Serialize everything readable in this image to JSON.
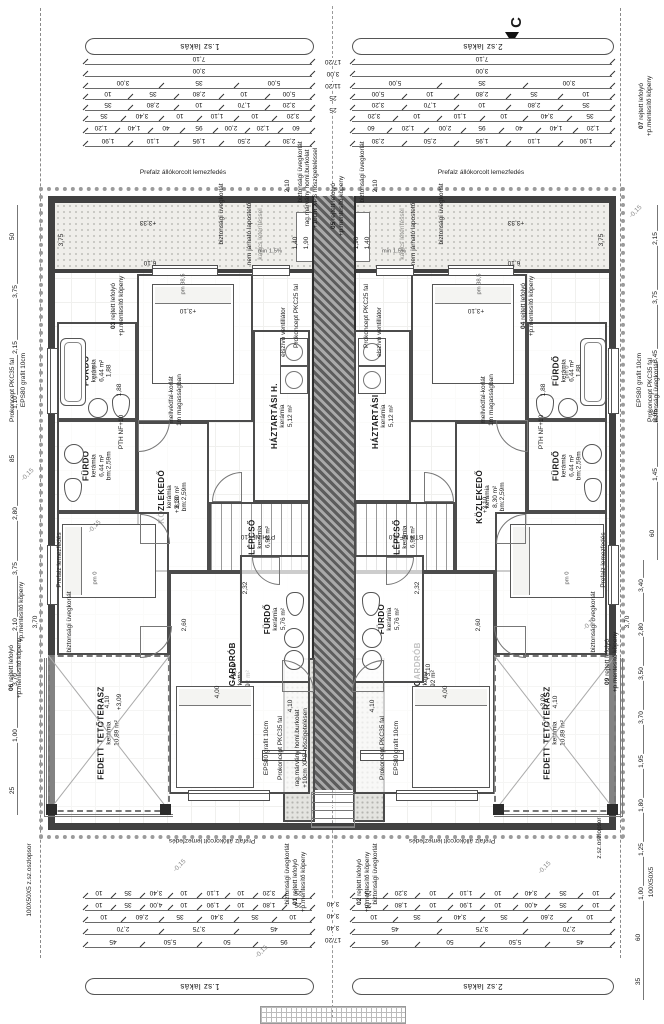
{
  "meta": {
    "drawing_type": "emeleti alaprajz (duplex floor plan)",
    "section_marker": "C",
    "units": [
      "1.sz lakás",
      "2.sz lakás"
    ]
  },
  "colors": {
    "wall": "#414141",
    "line": "#6a6a6a",
    "text": "#1a1a1a",
    "roof_fill": "#efeeea",
    "hatch": "#a9a9a9",
    "marker": "#111111"
  },
  "banners": {
    "top_left": "1.sz lakás",
    "top_right": "2.sz lakás",
    "bottom_left": "1.sz lakás",
    "bottom_right": "2.sz lakás"
  },
  "rooms": [
    {
      "name": "FÜRDŐ",
      "finish": "kerámia",
      "area": "6,44 m²",
      "extra": "1,88",
      "x": 57,
      "y": 322,
      "w": 80,
      "h": 98
    },
    {
      "name": "FÜRDŐ",
      "finish": "kerámia",
      "area": "6,44 m²",
      "extra": "bm:2,59m",
      "x": 57,
      "y": 420,
      "w": 80,
      "h": 92
    },
    {
      "name": "SZOBA",
      "finish": "parketta",
      "area": "15,00 m²",
      "extra": "bm:2,59m",
      "x": 137,
      "y": 274,
      "w": 116,
      "h": 148
    },
    {
      "name": "HÁZTARTÁSI H.",
      "finish": "kerámia",
      "area": "5,12 m²",
      "extra": "",
      "x": 253,
      "y": 330,
      "w": 57,
      "h": 172
    },
    {
      "name": "KÖZLEKEDŐ",
      "finish": "kerámia",
      "area": "8,30 m²",
      "extra": "bm:2,59m",
      "x": 137,
      "y": 422,
      "w": 72,
      "h": 150
    },
    {
      "name": "LÉPCSŐ",
      "finish": "kerámia",
      "area": "6,98 m²",
      "extra": "",
      "x": 209,
      "y": 502,
      "w": 101,
      "h": 70,
      "kind": "stairs"
    },
    {
      "name": "SZOBA",
      "finish": "parketta",
      "area": "16,35 m²",
      "extra": "",
      "x": 57,
      "y": 512,
      "w": 112,
      "h": 143
    },
    {
      "name": "SZOBA+ GARDRÓB",
      "finish": "parketta",
      "area": "23,92 m²",
      "extra": "",
      "x": 169,
      "y": 572,
      "w": 141,
      "h": 222
    },
    {
      "name": "FÜRDŐ",
      "finish": "kerámia",
      "area": "5,76 m²",
      "extra": "",
      "x": 240,
      "y": 555,
      "w": 70,
      "h": 128
    },
    {
      "name": "FEDETT TETŐTERASZ",
      "finish": "kerámia",
      "area": "10,89 m²",
      "extra": "",
      "x": 48,
      "y": 655,
      "w": 122,
      "h": 157,
      "kind": "terrace"
    }
  ],
  "notes": [
    {
      "num": "01",
      "text": "rejtett lefolyó\n+p.mentesítő köpeny",
      "x": 300,
      "y": 882
    },
    {
      "num": "02",
      "text": "rejtett lefolyó\n+p.mentesítő köpeny",
      "x": 364,
      "y": 882
    },
    {
      "num": "03",
      "text": "rejtett lefolyó\n+p.mentesítő köpeny",
      "x": 118,
      "y": 306
    },
    {
      "num": "04",
      "text": "rejtett lefolyó\n+p.mentesítő köpeny",
      "x": 528,
      "y": 306
    },
    {
      "num": "05",
      "text": "rejtett lefolyó\n+p.mentesítő köpeny",
      "x": 338,
      "y": 206
    },
    {
      "num": "06",
      "text": "rejtett lefolyó\n+p.mentesítő köpeny",
      "x": 16,
      "y": 668
    },
    {
      "num": "07",
      "text": "rejtett lefolyó\n+p.mentesítő köpeny",
      "x": 646,
      "y": 106
    },
    {
      "num": "09",
      "text": "rejtett lefolyó\n+p.mentesítő köpeny",
      "x": 612,
      "y": 662
    }
  ],
  "annotations": [
    {
      "t": "Prefalz állókorcolt lemezfedés",
      "x": 183,
      "y": 173,
      "r": "h",
      "m": true
    },
    {
      "t": "biztonsági üvegkorlát",
      "x": 222,
      "y": 214,
      "r": "v",
      "m": true
    },
    {
      "t": "nem járható lapostető",
      "x": 250,
      "y": 234,
      "r": "v",
      "m": true
    },
    {
      "t": "kavics leterítéssel",
      "x": 261,
      "y": 234,
      "r": "v",
      "m": true,
      "cls": "gray"
    },
    {
      "t": "+3,33",
      "x": 148,
      "y": 222,
      "r": "u",
      "m": true
    },
    {
      "t": "6,10",
      "x": 150,
      "y": 262,
      "r": "u",
      "m": true
    },
    {
      "t": "3,75",
      "x": 62,
      "y": 240,
      "r": "v",
      "m": true
    },
    {
      "t": "1,40",
      "x": 296,
      "y": 243,
      "r": "v",
      "m": true
    },
    {
      "t": "1,90",
      "x": 307,
      "y": 243,
      "r": "v",
      "m": true
    },
    {
      "t": "min 1,5%",
      "x": 270,
      "y": 252,
      "r": "h",
      "m": true,
      "cls": "small"
    },
    {
      "t": "rag.márvány homl.burkolat\n+10cm XPS hőszigeteléssel",
      "x": 312,
      "y": 188,
      "r": "v",
      "m": false
    },
    {
      "t": "biztonsági üvegkorlát",
      "x": 301,
      "y": 172,
      "r": "v",
      "m": true
    },
    {
      "t": "2,10",
      "x": 288,
      "y": 186,
      "r": "v",
      "m": true
    },
    {
      "t": "Prokoncept PKC25 fal",
      "x": 297,
      "y": 316,
      "r": "v",
      "m": true
    },
    {
      "t": "elszívó ventillátor",
      "x": 284,
      "y": 332,
      "r": "v",
      "m": true
    },
    {
      "t": "EPS80 grafit 10cm",
      "x": 24,
      "y": 380,
      "r": "v",
      "m": true
    },
    {
      "t": "Prokoncept PKC35 fal",
      "x": 13,
      "y": 390,
      "r": "v",
      "m": true
    },
    {
      "t": "biztonsági üvegkorlát",
      "x": 657,
      "y": 392,
      "r": "v",
      "m": false
    },
    {
      "t": "mellvédfal-korlát\n1m magasságban",
      "x": 176,
      "y": 400,
      "r": "v",
      "m": true
    },
    {
      "t": "PTH NF+10",
      "x": 122,
      "y": 432,
      "r": "v",
      "m": true
    },
    {
      "t": "PTH NF+10",
      "x": 258,
      "y": 536,
      "r": "u",
      "m": false
    },
    {
      "t": "BTH NF+10",
      "x": 406,
      "y": 536,
      "r": "u",
      "m": false
    },
    {
      "t": "+3,10",
      "x": 188,
      "y": 310,
      "r": "u",
      "m": true
    },
    {
      "t": "+3,10",
      "x": 178,
      "y": 505,
      "r": "v",
      "m": true
    },
    {
      "t": "+3,10",
      "x": 235,
      "y": 672,
      "r": "v",
      "m": true
    },
    {
      "t": "+3,09",
      "x": 120,
      "y": 702,
      "r": "v",
      "m": true
    },
    {
      "t": "1,88",
      "x": 120,
      "y": 390,
      "r": "v",
      "m": true
    },
    {
      "t": "Prefalz lemezfedés",
      "x": 60,
      "y": 560,
      "r": "v",
      "m": true
    },
    {
      "t": "+p.mentesítő köpeny",
      "x": 22,
      "y": 612,
      "r": "v",
      "m": false
    },
    {
      "t": "biztonsági üvegkorlát",
      "x": 70,
      "y": 622,
      "r": "v",
      "m": true
    },
    {
      "t": "3,70",
      "x": 36,
      "y": 622,
      "r": "v",
      "m": true
    },
    {
      "t": "4,10",
      "x": 108,
      "y": 702,
      "r": "v",
      "m": true
    },
    {
      "t": "2,60",
      "x": 185,
      "y": 625,
      "r": "v",
      "m": true
    },
    {
      "t": "4,00",
      "x": 218,
      "y": 692,
      "r": "v",
      "m": true
    },
    {
      "t": "2,32",
      "x": 246,
      "y": 588,
      "r": "v",
      "m": true
    },
    {
      "t": "4,10",
      "x": 291,
      "y": 706,
      "r": "v",
      "m": true
    },
    {
      "t": "EPS80 grafit 10cm",
      "x": 267,
      "y": 748,
      "r": "v",
      "m": true
    },
    {
      "t": "Prokoncept PKC35 fal",
      "x": 281,
      "y": 748,
      "r": "v",
      "m": true
    },
    {
      "t": "rag.márvány homl.burkolat\n+10cm XPS hőszigetelésen",
      "x": 302,
      "y": 748,
      "r": "v",
      "m": false
    },
    {
      "t": "biztonsági üvegkorlát",
      "x": 288,
      "y": 874,
      "r": "v",
      "m": true
    },
    {
      "t": "Prefalz állókorcolt lemezfedés",
      "x": 212,
      "y": 840,
      "r": "u",
      "m": true
    },
    {
      "t": "100X50X5 z.sz.oszlopsor",
      "x": 30,
      "y": 880,
      "r": "v",
      "m": false
    },
    {
      "t": "100X50X5",
      "x": 652,
      "y": 882,
      "r": "v",
      "m": false
    },
    {
      "t": "z.sz.oszlopsor",
      "x": 600,
      "y": 838,
      "r": "v",
      "m": false
    },
    {
      "t": "pm 0",
      "x": 96,
      "y": 372,
      "r": "v",
      "m": true,
      "cls": "small"
    },
    {
      "t": "pm 0",
      "x": 96,
      "y": 578,
      "r": "v",
      "m": true,
      "cls": "small"
    },
    {
      "t": "pm 38,5",
      "x": 184,
      "y": 284,
      "r": "v",
      "m": true,
      "cls": "small"
    },
    {
      "t": "-0,15",
      "x": 28,
      "y": 475,
      "r": "d",
      "m": false
    },
    {
      "t": "-0,15",
      "x": 95,
      "y": 527,
      "r": "d",
      "m": false
    },
    {
      "t": "-0,15",
      "x": 636,
      "y": 212,
      "r": "d",
      "m": false
    },
    {
      "t": "-0,15",
      "x": 590,
      "y": 624,
      "r": "d",
      "m": false
    },
    {
      "t": "-0,15",
      "x": 180,
      "y": 866,
      "r": "d",
      "m": false
    },
    {
      "t": "-0,15",
      "x": 545,
      "y": 868,
      "r": "d",
      "m": false
    },
    {
      "t": "-0,15",
      "x": 262,
      "y": 952,
      "r": "d",
      "m": false
    }
  ],
  "dims": {
    "top_rows": [
      {
        "y": 64,
        "vals": [
          "7,10"
        ]
      },
      {
        "y": 76,
        "vals": [
          "3,00"
        ]
      },
      {
        "y": 88,
        "vals": [
          "3,00",
          "35",
          "5,00"
        ]
      },
      {
        "y": 99,
        "vals": [
          "10",
          "35",
          "2,80",
          "10",
          "5,00"
        ]
      },
      {
        "y": 110,
        "vals": [
          "35",
          "2,80",
          "10",
          "1,70",
          "3,20"
        ]
      },
      {
        "y": 121,
        "vals": [
          "35",
          "3,40",
          "10",
          "1,10",
          "10",
          "3,20"
        ]
      },
      {
        "y": 133,
        "vals": [
          "1,20",
          "1,40",
          "40",
          "95",
          "2,00",
          "1,20",
          "60"
        ]
      },
      {
        "y": 146,
        "vals": [
          "1,90",
          "1,10",
          "1,95",
          "2,50",
          "2,30"
        ]
      }
    ],
    "bottom_rows": [
      {
        "y": 898,
        "vals": [
          "10",
          "35",
          "3,40",
          "10",
          "1,10",
          "10",
          "3,20",
          "25"
        ]
      },
      {
        "y": 910,
        "vals": [
          "10",
          "35",
          "4,00",
          "10",
          "1,90",
          "10",
          "1,80",
          "25"
        ]
      },
      {
        "y": 922,
        "vals": [
          "10",
          "2,60",
          "35",
          "3,40",
          "35",
          "10"
        ]
      },
      {
        "y": 934,
        "vals": [
          "2,70",
          "3,75",
          "45"
        ]
      },
      {
        "y": 947,
        "vals": [
          "45",
          "5,50",
          "50",
          "95"
        ]
      }
    ],
    "center_top": {
      "x": 333,
      "y0": 58,
      "vals": [
        "17/20",
        "3,00",
        "11/20",
        "25",
        "25"
      ]
    },
    "center_bottom": {
      "x": 333,
      "y0": 900,
      "vals": [
        "3,40",
        "3,40",
        "3,40",
        "17/20"
      ]
    },
    "left_col": {
      "x": 8,
      "y0": 205,
      "y1": 815,
      "vals": [
        "50",
        "3,75",
        "2,15",
        "1,10",
        "85",
        "2,80",
        "3,75",
        "2,10",
        "3,70",
        "1,00",
        "25"
      ]
    },
    "right_col_a": {
      "x": 648,
      "y0": 205,
      "y1": 560,
      "vals": [
        "2,15",
        "3,75",
        "3,45",
        "2,05",
        "1,45",
        "60"
      ]
    },
    "right_col_b": {
      "x": 634,
      "y0": 560,
      "y1": 1000,
      "vals": [
        "3,40",
        "2,80",
        "3,50",
        "3,70",
        "1,95",
        "1,80",
        "1,25",
        "1,00",
        "60",
        "35"
      ]
    }
  },
  "fixtures": [
    {
      "type": "tub",
      "x": 60,
      "y": 338,
      "w": 24,
      "h": 66
    },
    {
      "type": "wc",
      "x": 112,
      "y": 394,
      "w": 16,
      "h": 22
    },
    {
      "type": "sink",
      "x": 88,
      "y": 398,
      "w": 18,
      "h": 18
    },
    {
      "type": "sink",
      "x": 64,
      "y": 444,
      "w": 18,
      "h": 18
    },
    {
      "type": "wc",
      "x": 64,
      "y": 478,
      "w": 16,
      "h": 22
    },
    {
      "type": "bed",
      "x": 152,
      "y": 284,
      "w": 80,
      "h": 98
    },
    {
      "type": "bed2",
      "x": 62,
      "y": 524,
      "w": 92,
      "h": 72
    },
    {
      "type": "bed",
      "x": 176,
      "y": 686,
      "w": 76,
      "h": 100
    },
    {
      "type": "washer",
      "x": 280,
      "y": 338,
      "w": 26,
      "h": 26
    },
    {
      "type": "washer",
      "x": 280,
      "y": 366,
      "w": 26,
      "h": 26
    },
    {
      "type": "wc",
      "x": 286,
      "y": 592,
      "w": 16,
      "h": 22
    },
    {
      "type": "sink",
      "x": 284,
      "y": 628,
      "w": 18,
      "h": 18
    },
    {
      "type": "sink",
      "x": 284,
      "y": 650,
      "w": 18,
      "h": 18
    },
    {
      "type": "xcross",
      "x": 48,
      "y": 655,
      "w": 122,
      "h": 157
    },
    {
      "type": "col",
      "x": 46,
      "y": 804,
      "w": 11,
      "h": 11
    },
    {
      "type": "col",
      "x": 160,
      "y": 804,
      "w": 11,
      "h": 11
    },
    {
      "type": "door",
      "x": 138,
      "y": 420,
      "w": 30,
      "h": 30,
      "o": "br"
    },
    {
      "type": "door",
      "x": 212,
      "y": 472,
      "w": 28,
      "h": 28,
      "o": "tl"
    },
    {
      "type": "door",
      "x": 140,
      "y": 514,
      "w": 28,
      "h": 28,
      "o": "tr"
    },
    {
      "type": "door",
      "x": 252,
      "y": 557,
      "w": 26,
      "h": 26,
      "o": "bl"
    },
    {
      "type": "door",
      "x": 282,
      "y": 660,
      "w": 30,
      "h": 30,
      "o": "tr"
    },
    {
      "type": "door",
      "x": 140,
      "y": 626,
      "w": 30,
      "h": 30,
      "o": "br"
    }
  ],
  "windows": [
    {
      "x": 47,
      "y": 348,
      "w": 9,
      "h": 64,
      "v": true
    },
    {
      "x": 47,
      "y": 545,
      "w": 9,
      "h": 58,
      "v": true
    },
    {
      "x": 152,
      "y": 265,
      "w": 64,
      "h": 9
    },
    {
      "x": 252,
      "y": 265,
      "w": 36,
      "h": 9
    },
    {
      "x": 188,
      "y": 790,
      "w": 80,
      "h": 9
    },
    {
      "x": 262,
      "y": 750,
      "w": 42,
      "h": 9
    }
  ]
}
